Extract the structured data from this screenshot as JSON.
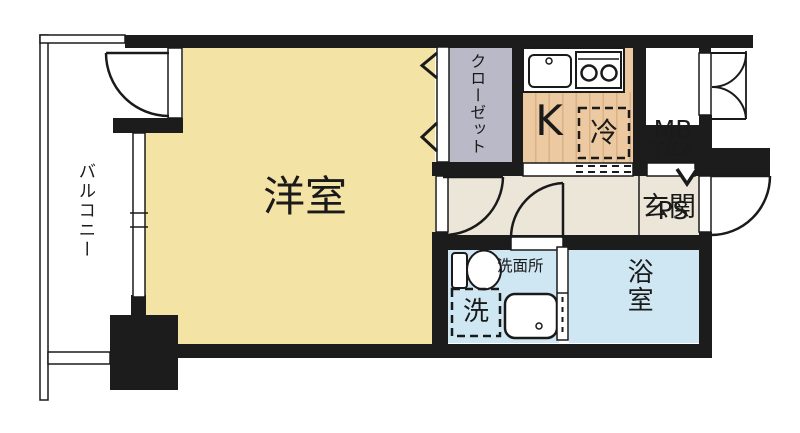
{
  "title": "1K apartment floor plan",
  "rooms": {
    "balcony": {
      "label": "バルコニー"
    },
    "western_room": {
      "label": "洋室"
    },
    "closet": {
      "label": "クローゼット"
    },
    "kitchen": {
      "label": "K"
    },
    "refrigerator": {
      "label": "冷"
    },
    "meter_box": {
      "line1": "MB",
      "line2": "PS"
    },
    "shoe_storage": {
      "label": "下足入"
    },
    "entrance": {
      "label": "玄関"
    },
    "washroom": {
      "label": "洗面所"
    },
    "washer": {
      "label": "洗"
    },
    "bathroom": {
      "label": "浴室"
    }
  },
  "fixtures": [
    "sink-icon",
    "stove-icon",
    "refrigerator-dashed-box",
    "toilet-icon",
    "washbasin-icon",
    "washing-machine-dashed-box",
    "entrance-step-arrow"
  ],
  "colors": {
    "wall": "#1c1c1c",
    "western_room": "#f3e3a4",
    "hall": "#ece6d9",
    "kitchen_floor": "#ecc9a0",
    "kitchen_stripe": "#d9b287",
    "closet": "#b9b9c7",
    "shoe_storage": "#b9b9c7",
    "water_area": "#cfe7f3",
    "white": "#ffffff",
    "line": "#1a1a1a"
  }
}
